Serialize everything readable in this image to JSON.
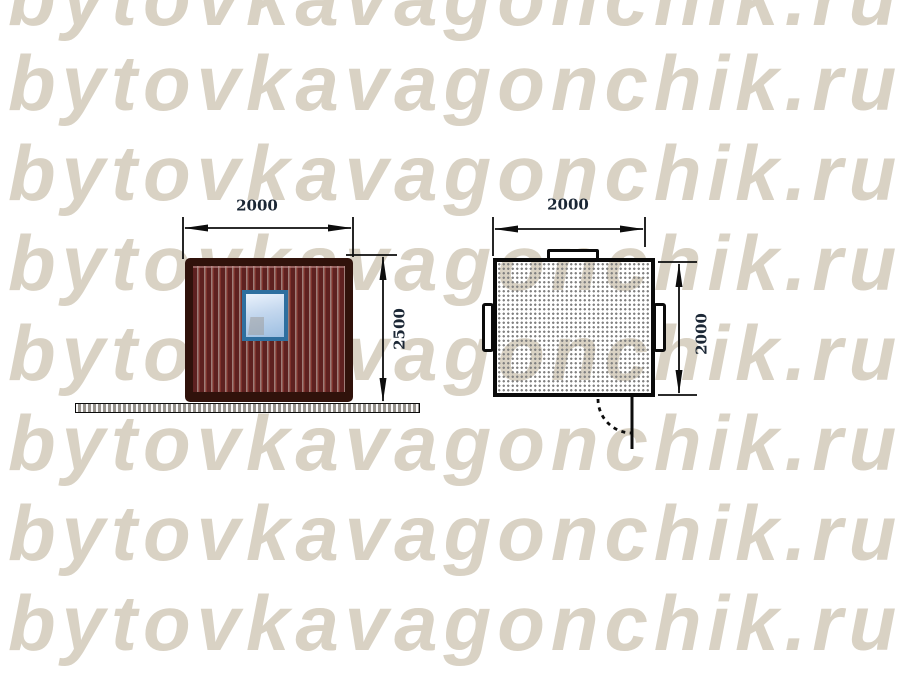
{
  "watermark": {
    "text": "bytovkavagonchik.ru",
    "color": "#d9d2c4"
  },
  "drawing": {
    "front_view": {
      "width_label": "2000",
      "height_label": "2500"
    },
    "plan_view": {
      "width_label": "2000",
      "depth_label": "2000"
    }
  },
  "colors": {
    "wall_corrugation_red": "#6b2624",
    "wall_frame_brown": "#30120b",
    "window_frame_blue": "#2e6f9f",
    "window_glass_light": "#c3d7ee",
    "ground_gray": "#96928c",
    "linework_black": "#0d0d0d",
    "dimension_text": "#1b2735",
    "plan_stipple_gray": "#808080"
  }
}
